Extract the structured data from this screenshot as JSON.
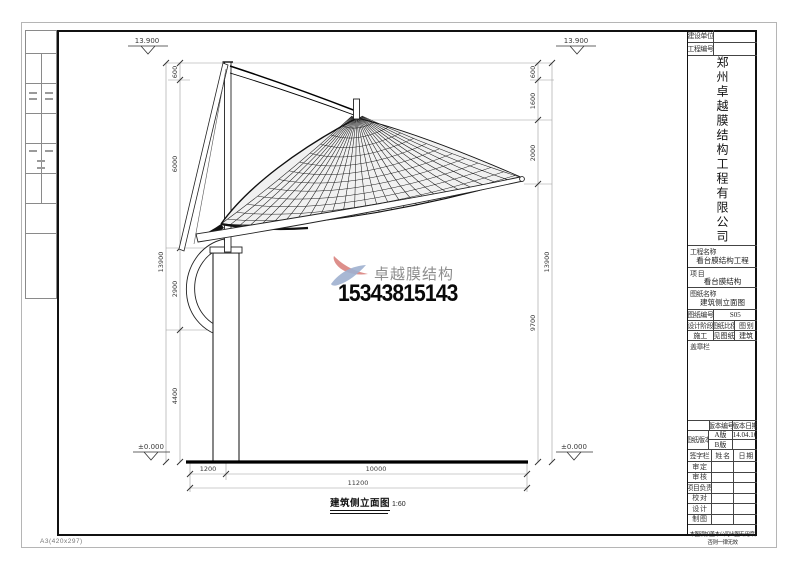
{
  "sheet": {
    "paper_label": "A3(420x297)"
  },
  "title_block": {
    "owner_label": "建设单位",
    "project_no_label": "工程编号",
    "company_name": "郑州卓越膜结构工程有限公司",
    "project_name_label": "工程名称",
    "project_name": "看台膜结构工程",
    "item_label": "项  目",
    "item_value": "看台膜结构",
    "drawing_name_label": "图纸名称",
    "drawing_name": "建筑侧立面图",
    "drawing_no_label": "图纸编号",
    "drawing_no": "S05",
    "stage_label": "设计阶段",
    "scale_label": "图纸比例",
    "category_label": "图 别",
    "stage_value": "施工",
    "scale_value": "见图纸",
    "category_value": "建筑",
    "stamp_label": "盖章栏",
    "version_label": "图纸版本",
    "version_no_label": "版本编号",
    "version_date_label": "版本日期",
    "versions": [
      {
        "no": "A版",
        "date": "14.04.16"
      },
      {
        "no": "B版",
        "date": ""
      }
    ],
    "sign_label": "签字栏",
    "name_label": "姓 名",
    "date_label": "日 期",
    "sign_rows": [
      "审 定",
      "审 核",
      "项目负责",
      "校 对",
      "设 计",
      "制 图"
    ],
    "note": "本图须加盖本公司出图专用章,否则一律无效"
  },
  "watermark": {
    "brand": "卓越膜结构",
    "phone": "15343815143",
    "logo_red": "#dd8f8b",
    "logo_blue": "#9fb0cf"
  },
  "drawing": {
    "title": "建筑侧立面图",
    "scale": "1:60",
    "levels": {
      "top_left": "13.900",
      "top_right": "13.900",
      "ground_left": "±0.000",
      "ground_right": "±0.000"
    },
    "dims": {
      "left": [
        "600",
        "6000",
        "2900",
        "4400"
      ],
      "left_total": "13900",
      "right": [
        "600",
        "1600",
        "2000",
        "9700"
      ],
      "right_total": "13900",
      "bottom": [
        "1200",
        "10000"
      ],
      "bottom_total": "11200"
    }
  }
}
